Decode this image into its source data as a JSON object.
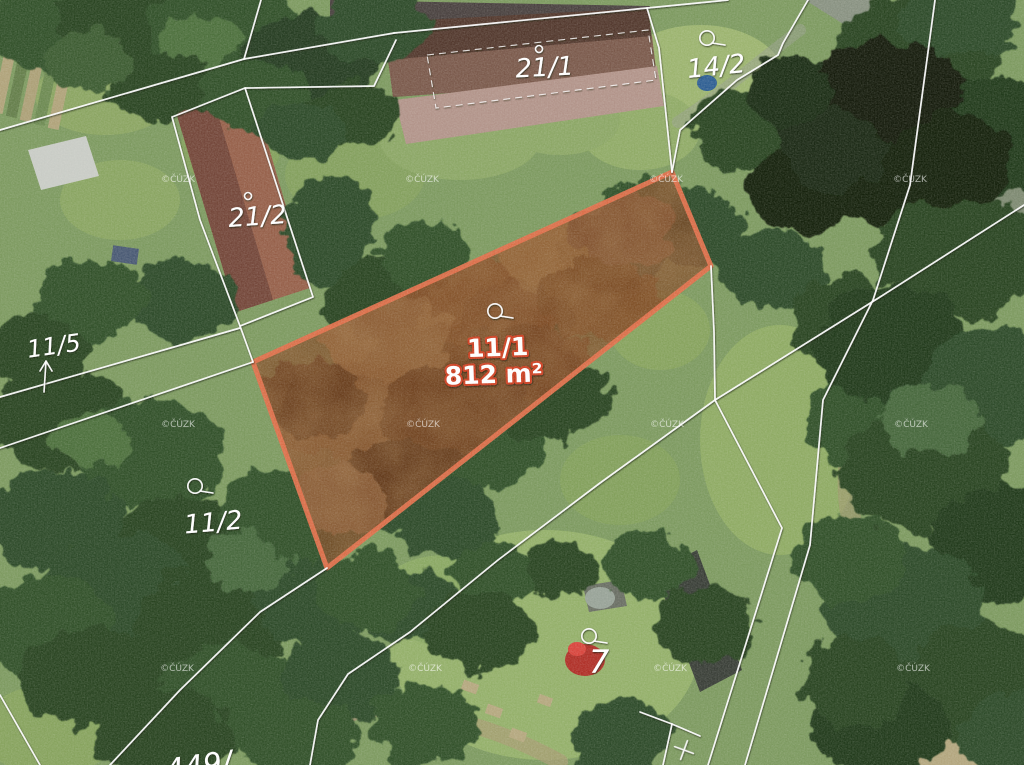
{
  "title": "Aerial cadastral map with highlighted parcel 11/1 (812 m²)",
  "map": {
    "width": 1024,
    "height": 765,
    "base_color": "#7d9a60",
    "boundary_color": "#ffffff",
    "watermark": {
      "text": "©ČÚZK",
      "positions": [
        [
          178,
          182
        ],
        [
          422,
          182
        ],
        [
          666,
          182
        ],
        [
          910,
          182
        ],
        [
          178,
          427
        ],
        [
          423,
          427
        ],
        [
          667,
          427
        ],
        [
          911,
          427
        ],
        [
          177,
          671
        ],
        [
          425,
          671
        ],
        [
          670,
          671
        ],
        [
          913,
          671
        ]
      ]
    },
    "parcel_labels": [
      {
        "id": "21-1",
        "text": "21/1",
        "x": 545,
        "y": 76,
        "fs": 26,
        "rot": -3
      },
      {
        "id": "14-2",
        "text": "14/2",
        "x": 717,
        "y": 75,
        "fs": 26,
        "rot": -6
      },
      {
        "id": "21-2",
        "text": "21/2",
        "x": 258,
        "y": 225,
        "fs": 26,
        "rot": -4
      },
      {
        "id": "11-5",
        "text": "11/5",
        "x": 55,
        "y": 354,
        "fs": 24,
        "rot": -8
      },
      {
        "id": "11-2",
        "text": "11/2",
        "x": 214,
        "y": 531,
        "fs": 26,
        "rot": -5
      },
      {
        "id": "7",
        "text": "7",
        "x": 599,
        "y": 673,
        "fs": 32,
        "rot": 0
      },
      {
        "id": "449",
        "text": "449/",
        "x": 200,
        "y": 776,
        "fs": 30,
        "rot": -8
      }
    ],
    "highlight_parcel": {
      "number": "11/1",
      "area_label": "812 m²",
      "polygon": "253,362 672,172 711,266 327,568",
      "stroke_color": "#e0704b",
      "fill_color": "#7c4a27",
      "halo_color": "#cd4023",
      "label": {
        "x": 498,
        "y": 356,
        "fs": 25,
        "rot": -2
      },
      "area": {
        "x": 494,
        "y": 383,
        "fs": 25,
        "rot": -2
      },
      "texture": [
        [
          350,
          420,
          85,
          55,
          "#8f5a31"
        ],
        [
          470,
          310,
          85,
          55,
          "#874d25"
        ],
        [
          560,
          255,
          65,
          45,
          "#9a6639"
        ],
        [
          420,
          480,
          75,
          45,
          "#5e3316"
        ],
        [
          312,
          398,
          55,
          38,
          "#6b3a1c"
        ],
        [
          520,
          380,
          85,
          55,
          "#7c4722"
        ],
        [
          620,
          228,
          55,
          40,
          "#8a5530"
        ],
        [
          388,
          338,
          65,
          42,
          "#996438"
        ],
        [
          300,
          490,
          55,
          38,
          "#885a30"
        ],
        [
          455,
          408,
          75,
          45,
          "#6f3e1e"
        ],
        [
          600,
          300,
          60,
          40,
          "#7f4823"
        ],
        [
          340,
          500,
          50,
          34,
          "#93603a"
        ]
      ]
    },
    "boundaries": [
      "261,0 244,59 0,130",
      "244,59 394,33",
      "394,33 647,8 659,48 672,172",
      "396,40 374,86 245,88",
      "172,117 245,88 313,297 240,326 200,220 172,117",
      "0,397 240,328",
      "0,448 253,362",
      "240,326 253,362",
      "327,568 260,612 180,690 110,765",
      "715,400 600,483 498,560 410,632 348,674 318,720 310,765",
      "935,0 910,185 873,300 823,400 810,545 745,765",
      "1024,205 880,297 715,400",
      "715,400 782,528 708,765",
      "808,0 783,43 778,55 737,80 680,130 672,172",
      "640,712 672,724 700,736",
      "672,724 663,765",
      "711,266 714,332 715,400",
      "647,8 728,0",
      "0,695 40,765"
    ],
    "building_outline": {
      "points": "427,55 648,30 656,80 436,108"
    },
    "symbols": {
      "circle_tail": [
        [
          495,
          311
        ],
        [
          707,
          38
        ],
        [
          195,
          486
        ],
        [
          589,
          636
        ]
      ],
      "ring": [
        [
          539,
          49
        ],
        [
          248,
          196
        ]
      ],
      "arrow": {
        "x1": 44,
        "y1": 392,
        "x2": 46,
        "y2": 361
      },
      "cross": {
        "x": 684,
        "y": 750,
        "rot": 20
      }
    },
    "terrain": {
      "road": "805,0 885,0 1024,108 1024,150 872,42",
      "road_color": "#8b9186",
      "dirt_paths": [
        {
          "d": "M1012,215 C930,285 855,360 848,470 C842,565 905,645 1015,705",
          "w": 20,
          "c": "#a1976f",
          "o": 0.6
        },
        {
          "d": "M560,762 C480,718 395,700 298,712",
          "w": 16,
          "c": "#a89b74",
          "o": 0.7
        },
        {
          "d": "M800,30 C760,60 720,95 678,122",
          "w": 12,
          "c": "#97a08b",
          "o": 0.55
        }
      ],
      "grass": [
        [
          105,
          95,
          70,
          40,
          "#8ba562"
        ],
        [
          700,
          80,
          85,
          55,
          "#9cb46f"
        ],
        [
          640,
          130,
          60,
          40,
          "#90ab67"
        ],
        [
          780,
          440,
          80,
          115,
          "#8fab64"
        ],
        [
          545,
          645,
          155,
          115,
          "#94b06a"
        ],
        [
          445,
          600,
          70,
          45,
          "#8aa863"
        ],
        [
          50,
          730,
          70,
          45,
          "#87a35e"
        ],
        [
          355,
          175,
          70,
          45,
          "#84a05e"
        ],
        [
          120,
          200,
          60,
          40,
          "#8aa562"
        ],
        [
          460,
          140,
          80,
          40,
          "#8ca766"
        ],
        [
          980,
          240,
          50,
          40,
          "#7e9a5e"
        ],
        [
          660,
          330,
          50,
          40,
          "#87a35e"
        ],
        [
          230,
          150,
          50,
          35,
          "#83a05c"
        ],
        [
          560,
          120,
          60,
          35,
          "#8ca766"
        ],
        [
          620,
          480,
          60,
          45,
          "#83a05c"
        ]
      ],
      "tan_patches": [
        [
          940,
          745,
          80,
          35,
          "#b3a67e"
        ],
        [
          1000,
          700,
          60,
          40,
          "#ab9e77"
        ],
        [
          870,
          600,
          45,
          40,
          "#a39770"
        ],
        [
          330,
          700,
          45,
          25,
          "#9a8f6d"
        ]
      ],
      "trees": [
        [
          40,
          30,
          60,
          40,
          "#33512c"
        ],
        [
          130,
          20,
          75,
          40,
          "#2a4424"
        ],
        [
          225,
          30,
          80,
          45,
          "#33512c"
        ],
        [
          310,
          60,
          70,
          45,
          "#273e22"
        ],
        [
          375,
          25,
          55,
          35,
          "#2f4c29"
        ],
        [
          165,
          85,
          55,
          35,
          "#2a4424"
        ],
        [
          255,
          95,
          55,
          35,
          "#33512c"
        ],
        [
          90,
          60,
          45,
          30,
          "#3c5c33"
        ],
        [
          350,
          115,
          50,
          32,
          "#2a4424"
        ],
        [
          300,
          130,
          45,
          30,
          "#2f4c29"
        ],
        [
          200,
          40,
          40,
          25,
          "#4d6f3e"
        ],
        [
          330,
          230,
          45,
          55,
          "#2f4c29"
        ],
        [
          375,
          300,
          50,
          40,
          "#2a4424"
        ],
        [
          425,
          255,
          45,
          35,
          "#33512c"
        ],
        [
          180,
          300,
          55,
          40,
          "#2f4c29"
        ],
        [
          90,
          300,
          55,
          42,
          "#33512c"
        ],
        [
          38,
          352,
          50,
          38,
          "#2a4424"
        ],
        [
          60,
          420,
          70,
          50,
          "#2a4424"
        ],
        [
          150,
          455,
          75,
          55,
          "#33512c"
        ],
        [
          55,
          520,
          70,
          50,
          "#2f4c29"
        ],
        [
          185,
          545,
          70,
          50,
          "#2a4424"
        ],
        [
          280,
          515,
          60,
          45,
          "#33512c"
        ],
        [
          120,
          590,
          80,
          55,
          "#2f4c29"
        ],
        [
          45,
          625,
          70,
          50,
          "#33512c"
        ],
        [
          210,
          625,
          75,
          55,
          "#2a4424"
        ],
        [
          310,
          595,
          60,
          45,
          "#2f4c29"
        ],
        [
          95,
          680,
          75,
          50,
          "#2a4424"
        ],
        [
          230,
          695,
          75,
          50,
          "#33512c"
        ],
        [
          340,
          675,
          60,
          45,
          "#2f4c29"
        ],
        [
          165,
          735,
          70,
          45,
          "#2a4424"
        ],
        [
          300,
          740,
          60,
          40,
          "#33512c"
        ],
        [
          90,
          440,
          40,
          28,
          "#4d6f3e"
        ],
        [
          250,
          560,
          45,
          30,
          "#46683c"
        ],
        [
          340,
          410,
          65,
          48,
          "#2f4c29"
        ],
        [
          430,
          370,
          65,
          48,
          "#33512c"
        ],
        [
          515,
          325,
          60,
          45,
          "#2a4424"
        ],
        [
          390,
          480,
          70,
          50,
          "#2f4c29"
        ],
        [
          480,
          440,
          65,
          48,
          "#33512c"
        ],
        [
          550,
          395,
          60,
          45,
          "#2a4424"
        ],
        [
          610,
          250,
          55,
          42,
          "#2f4c29"
        ],
        [
          650,
          210,
          45,
          35,
          "#33512c"
        ],
        [
          310,
          520,
          55,
          40,
          "#33512c"
        ],
        [
          450,
          520,
          55,
          38,
          "#2f4c29"
        ],
        [
          700,
          230,
          45,
          35,
          "#2f4c29"
        ],
        [
          745,
          130,
          55,
          40,
          "#2a4424"
        ],
        [
          800,
          190,
          55,
          42,
          "#16230f"
        ],
        [
          770,
          270,
          55,
          40,
          "#2f4c29"
        ],
        [
          845,
          320,
          55,
          45,
          "#2a4424"
        ],
        [
          865,
          420,
          60,
          48,
          "#33512c"
        ],
        [
          820,
          120,
          45,
          35,
          "#1a2a12"
        ],
        [
          405,
          605,
          50,
          36,
          "#2f4c29"
        ],
        [
          650,
          565,
          45,
          34,
          "#33512c"
        ],
        [
          705,
          625,
          50,
          40,
          "#2a4424"
        ],
        [
          425,
          725,
          55,
          40,
          "#33512c"
        ],
        [
          620,
          735,
          50,
          38,
          "#2f4c29"
        ],
        [
          560,
          570,
          40,
          30,
          "#2a4424"
        ],
        [
          490,
          575,
          40,
          30,
          "#33512c"
        ],
        [
          480,
          630,
          55,
          40,
          "#2a4424"
        ],
        [
          370,
          590,
          50,
          38,
          "#33512c"
        ],
        [
          915,
          55,
          85,
          60,
          "#2a4424"
        ],
        [
          995,
          135,
          80,
          60,
          "#223a1d"
        ],
        [
          895,
          170,
          75,
          55,
          "#16230f"
        ],
        [
          960,
          255,
          85,
          62,
          "#2a4424"
        ],
        [
          890,
          345,
          75,
          58,
          "#223a1d"
        ],
        [
          995,
          385,
          75,
          58,
          "#2f4c29"
        ],
        [
          925,
          470,
          85,
          62,
          "#2a4424"
        ],
        [
          1005,
          545,
          75,
          58,
          "#223a1d"
        ],
        [
          905,
          605,
          80,
          58,
          "#2f4c29"
        ],
        [
          985,
          685,
          85,
          60,
          "#2a4424"
        ],
        [
          880,
          725,
          70,
          50,
          "#223a1d"
        ],
        [
          1015,
          735,
          55,
          45,
          "#2f4c29"
        ],
        [
          850,
          560,
          55,
          45,
          "#33512c"
        ],
        [
          855,
          680,
          55,
          45,
          "#2a4424"
        ],
        [
          960,
          20,
          60,
          40,
          "#2f4c29"
        ],
        [
          930,
          420,
          50,
          35,
          "#46683c"
        ],
        [
          885,
          90,
          75,
          50,
          "#131f0d"
        ],
        [
          950,
          160,
          65,
          48,
          "#15230e"
        ],
        [
          835,
          150,
          50,
          40,
          "#1a2a12"
        ],
        [
          790,
          90,
          45,
          35,
          "#1d2f15"
        ]
      ],
      "buildings": [
        {
          "name": "building-roof-ridge-strip",
          "points": "330,0 650,6 648,16 384,28 330,20",
          "fill": "#4a4240"
        },
        {
          "name": "building-21-1-roof",
          "points": "384,22 648,8 657,78 393,97",
          "fill": "#53392e"
        },
        {
          "name": "building-21-1-roof-lower",
          "points": "388,60 652,36 657,78 393,97",
          "fill": "#7b5a4c"
        },
        {
          "name": "building-21-1-yard",
          "points": "395,100 657,66 664,106 406,144",
          "fill": "#b2948a"
        },
        {
          "name": "building-21-2-roof",
          "points": "176,112 252,90 310,288 236,312",
          "fill": "#96604a"
        },
        {
          "name": "building-21-2-roof-dark",
          "points": "176,112 214,101 273,300 236,312",
          "fill": "#74473a"
        },
        {
          "name": "barn-white-roof",
          "points": "28,150 86,136 99,176 41,190",
          "fill": "#c9ccc6"
        },
        {
          "name": "barn-dark-roof",
          "points": "655,572 697,550 742,670 700,692",
          "fill": "#3a3f38"
        },
        {
          "name": "shed-roof",
          "points": "583,586 621,580 627,606 589,612",
          "fill": "#6a6f64"
        }
      ],
      "features": [
        {
          "t": "rect",
          "x": 2,
          "y": 14,
          "w": 11,
          "h": 100,
          "rot": 12,
          "fill": "#b0a37a"
        },
        {
          "t": "rect",
          "x": 16,
          "y": 18,
          "w": 11,
          "h": 100,
          "rot": 12,
          "fill": "#647e4a"
        },
        {
          "t": "rect",
          "x": 30,
          "y": 22,
          "w": 11,
          "h": 100,
          "rot": 12,
          "fill": "#aca077"
        },
        {
          "t": "rect",
          "x": 44,
          "y": 26,
          "w": 11,
          "h": 100,
          "rot": 12,
          "fill": "#6d8a52"
        },
        {
          "t": "rect",
          "x": 58,
          "y": 30,
          "w": 11,
          "h": 100,
          "rot": 12,
          "fill": "#b0a37a"
        },
        {
          "t": "rect",
          "x": 462,
          "y": 682,
          "w": 16,
          "h": 10,
          "rot": 20,
          "fill": "#b5a87f"
        },
        {
          "t": "rect",
          "x": 486,
          "y": 706,
          "w": 16,
          "h": 10,
          "rot": 20,
          "fill": "#b5a87f"
        },
        {
          "t": "rect",
          "x": 510,
          "y": 730,
          "w": 16,
          "h": 10,
          "rot": 20,
          "fill": "#b5a87f"
        },
        {
          "t": "rect",
          "x": 538,
          "y": 696,
          "w": 14,
          "h": 9,
          "rot": 20,
          "fill": "#b5a87f"
        },
        {
          "t": "rect",
          "x": 112,
          "y": 247,
          "w": 26,
          "h": 16,
          "rot": 8,
          "fill": "#4a5a74"
        },
        {
          "t": "ellipse",
          "cx": 585,
          "cy": 660,
          "rx": 20,
          "ry": 16,
          "fill": "#b03028"
        },
        {
          "t": "ellipse",
          "cx": 577,
          "cy": 649,
          "rx": 9,
          "ry": 7,
          "fill": "#d8453d"
        },
        {
          "t": "ellipse",
          "cx": 707,
          "cy": 83,
          "rx": 10,
          "ry": 8,
          "fill": "#2f5f93"
        },
        {
          "t": "ellipse",
          "cx": 440,
          "cy": 515,
          "rx": 38,
          "ry": 22,
          "fill": "#7d8f86"
        },
        {
          "t": "ellipse",
          "cx": 600,
          "cy": 598,
          "rx": 15,
          "ry": 11,
          "fill": "#98a398"
        },
        {
          "t": "ellipse",
          "cx": 1014,
          "cy": 205,
          "rx": 22,
          "ry": 55,
          "fill": "#7e8a72"
        }
      ]
    }
  }
}
